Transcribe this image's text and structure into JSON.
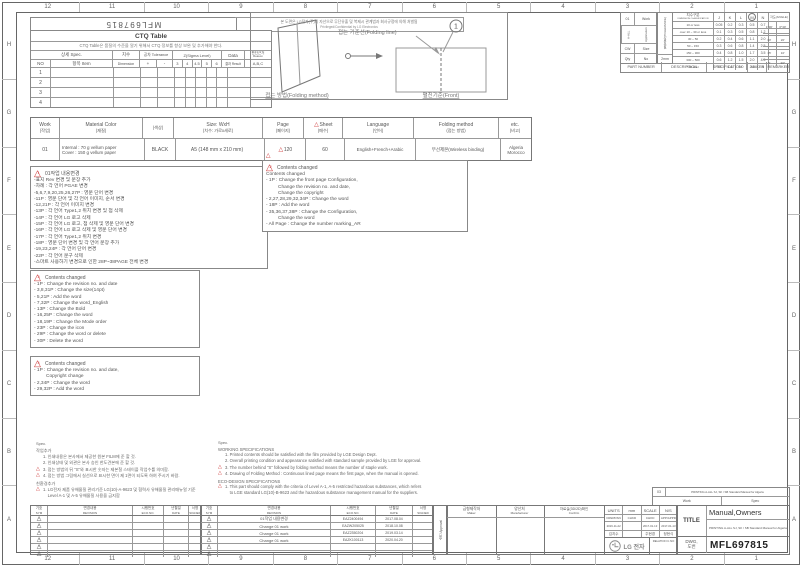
{
  "frame": {
    "top_ruler": [
      "12",
      "11",
      "10",
      "9",
      "8",
      "7",
      "6",
      "5",
      "4",
      "3",
      "2",
      "1"
    ],
    "bottom_ruler": [
      "12",
      "11",
      "10",
      "9",
      "8",
      "7",
      "6",
      "5",
      "4",
      "3",
      "2",
      "1"
    ],
    "left_ruler": [
      "H",
      "G",
      "F",
      "E",
      "D",
      "C",
      "B",
      "A"
    ],
    "right_ruler": [
      "H",
      "G",
      "F",
      "E",
      "D",
      "C",
      "B",
      "A"
    ]
  },
  "icons": {
    "revision_triangle": "△"
  },
  "header": {
    "doc_number_flipped": "MFL697815",
    "confidential_ko": "본 도면은 LG전자(주)의 자산으로 무단유출 및 복제시 관계법과 회사규정에 의해 처벌됨",
    "confidential_en": "Privileged/Confidential by LG Electronics"
  },
  "ctq": {
    "title": "CTQ Table",
    "note": "CTQ Table은 품질의 수준을 알기 위해서 CTQ 정보를 항상 보완 및 추가해야 한다.",
    "spec_header": "상세 Spec.",
    "no_header": "NO",
    "item_header": "항목 Item",
    "dim_ko": "치수",
    "dim_en": "Dimension",
    "tol_header": "공차 Tolerance",
    "tol_plus": "+",
    "tol_minus": "-",
    "sigma_header": "Z(Sigma Level)",
    "sigma_levels": [
      "3",
      "4",
      "4.5",
      "5",
      "6"
    ],
    "data_header": "Data",
    "result_header": "결과 Result",
    "reason_ko": "판단근거",
    "reason_en": "Reason",
    "reason_abc": "A,B,C",
    "rows": [
      "1",
      "2",
      "3",
      "4"
    ]
  },
  "fold": {
    "balloon": "1",
    "line_label": "접는 기준선(Folding line)",
    "method_label": "접는 방법(Folding method)",
    "front_label": "펼친기준(Front)"
  },
  "app_table": {
    "rows": [
      {
        "a": "01",
        "b": "Work"
      },
      {
        "a": "A-ALL",
        "b": "Application"
      },
      {
        "a": "CW",
        "b": "Size"
      },
      {
        "a": "Qty",
        "b": "No"
      }
    ]
  },
  "tol": {
    "band_label": "일반공차(TOLERANCE)",
    "band_note": "2mm",
    "head_ko": "치수구분",
    "head_en": "DIMENSION CLASSIFICATION",
    "cols": [
      "J",
      "K",
      "L",
      "M",
      "N"
    ],
    "angle_label": "각도(ANGLE)",
    "rows": [
      {
        "range": "10 or less",
        "j": "0.05",
        "k": "0.2",
        "l": "0.3",
        "m": "0.5",
        "n": "0.7"
      },
      {
        "range": "over 10 ~ 30 or less",
        "j": "0.1",
        "k": "0.3",
        "l": "0.5",
        "m": "0.8",
        "n": "1.2"
      },
      {
        "range": "30 ~ 50",
        "j": "0.2",
        "k": "0.4",
        "l": "0.6",
        "m": "1.1",
        "n": "2.0"
      },
      {
        "range": "50 ~ 150",
        "j": "0.3",
        "k": "0.6",
        "l": "0.8",
        "m": "1.4",
        "n": "2.5"
      },
      {
        "range": "150 ~ 300",
        "j": "0.4",
        "k": "0.8",
        "l": "1.0",
        "m": "1.7",
        "n": "3.5"
      },
      {
        "range": "300 ~ 500",
        "j": "0.6",
        "k": "1.2",
        "l": "1.5",
        "m": "2.0",
        "n": "4.5"
      },
      {
        "range": "500 over",
        "j": "0.8",
        "k": "1.6",
        "l": "2.0",
        "m": "2.5",
        "n": "6"
      }
    ],
    "angle_rows": [
      {
        "a": "1°30′",
        "b": "0°30′"
      },
      {
        "a": "30′",
        "b": "20′"
      },
      {
        "a": "15′",
        "b": "10′"
      },
      {
        "a": "5′",
        "b": "30″"
      }
    ]
  },
  "part_row": [
    "PART NUMBER",
    "DESCRIPTION",
    "SPECIFICATION",
    "MAKER",
    "REMARKER"
  ],
  "spec_table": {
    "headers": [
      {
        "en": "Work",
        "ko": "(작업)"
      },
      {
        "en": "Material Color",
        "ko": "(재질)"
      },
      {
        "en": "",
        "ko": "(색상)"
      },
      {
        "en": "Size: WxH",
        "ko": "(치수: 가로x세로)"
      },
      {
        "en": "Page",
        "ko": "(페이지)"
      },
      {
        "en": "Sheet",
        "ko": "(매수)"
      },
      {
        "en": "Language",
        "ko": "(언어)"
      },
      {
        "en": "Folding method",
        "ko": "(접는 방법)"
      },
      {
        "en": "etc.",
        "ko": "(비고)"
      }
    ],
    "row": {
      "work": "01",
      "material_1": "Internal : 70 g vellum paper",
      "material_2": "Cover : 150 g vellum paper",
      "color": "BLACK",
      "size": "A5 (148 mm x 210 mm)",
      "page": "120",
      "sheet": "60",
      "language": "English+French+Arabic",
      "folding": "무선제본(Wireless binding)",
      "etc_1": "Algeria",
      "etc_2": "Morocco"
    }
  },
  "boxes": [
    {
      "tri": "1",
      "title": "01작업 내용변경",
      "lines": [
        "-표지 Rev 변경 및 문장 추가",
        "-차례 : 각 언어 PGAE 변경",
        "-5,6,7,9,20,25,26,27P : 영문 단어 변경",
        "-11P : 영문 단어 및 각 언어 이미지, 순서 변경",
        "-12,21P : 각 언어 이미지 변경",
        "-13P : 각 언어 Type1,2 위치 변경 및 점 삭제",
        "-14P : 각 언어 LG 로고 삭제",
        "-15P : 각 언어 LG 로고, 점 삭제 및 영문 단어 변경",
        "-16P : 각 언어 LG 로고 삭제 및 영문 단어 변경",
        "-17P : 각 언어 Type1,2 위치 변경",
        "-18P : 영문 단어 변경 및 각 언어 문장 추가",
        "-19,23,24P : 각 언어 단어 변경",
        "-22P : 각 언어 문구 삭제",
        "-스마트 사용하기 변경으로 인한 28P~38PAGE 전체 변경"
      ]
    },
    {
      "tri": "2",
      "title": "Contents changed",
      "lines": [
        "Contents changed",
        "- 1P : Change the front page Configuration,",
        "         Change the revision no. and date,",
        "         Change the copyright",
        "- 2,27,28,29,32,34P : Change the word",
        "- 18P : Add the word",
        "- 35,36,37,38P : Change the Configuration,",
        "         Change the word",
        "- All Page : Change the number marking_AR"
      ]
    },
    {
      "tri": "3",
      "title": "Contents changed",
      "lines": [
        "- 1P : Change the revision no. and date",
        "- 3,8,31P : Change the size(14pt)",
        "- 5,21P : Add the word",
        "- 7,32P : Change the word_English",
        "- 13P : Change the Bold",
        "- 16,25P : Change the word",
        "- 18,19P : Change the Mode order",
        "- 23P : Change the icon",
        "- 29P : Change the word or delete",
        "- 30P : Delete the word"
      ]
    },
    {
      "tri": "4",
      "title": "Contents changed",
      "lines": [
        "- 1P : Change the revision no. and date,",
        "         Copyright change",
        "- 2,34P : Change the word",
        "- 29,32P : Add the word"
      ]
    }
  ],
  "notes_ko": {
    "spec": "Spec.",
    "sec1": "작업추가",
    "items1": [
      {
        "mark": "",
        "text": "1. 인쇄내용은 본사에서 제공한 원본 FILM에 준 할 것."
      },
      {
        "mark": "",
        "text": "2. 인쇄상태 및 외관은 본사 승인 한도견본에 준 할 것."
      },
      {
        "mark": "△",
        "text": "3. 접는 방법의 뒤 \"S\"와 표시한 숫자는 제본철 스테이플 작업수를 의미함."
      },
      {
        "mark": "△",
        "text": "4. 접는 방법 그림에서 실선으로 표시한 면이 제 1면이 되도록 하여 주시기 바람."
      }
    ],
    "sec2": "친환경추가",
    "items2": [
      {
        "mark": "△",
        "text": "1. LG전자 제품 유해물질 관리기준 LG(10)-A-9623 및 협력사 유해물질 관리매뉴얼 기준"
      },
      {
        "mark": "",
        "text": "    Level A-1 및 A-5 유해물질 사용을 금지함"
      }
    ]
  },
  "notes_en": {
    "spec": "Spec.",
    "sec1": "WORKING SPECIFICATIONS",
    "items1": [
      {
        "mark": "",
        "text": "1. Printed contents should be satisfied with the film provided by LGE Design Dept."
      },
      {
        "mark": "",
        "text": "2. Overall printing condition and appearance satisfied with standard sample provided by LGE for approval."
      },
      {
        "mark": "△",
        "text": "3. The number behind \"S\" followed by folding method means the number of staple work."
      },
      {
        "mark": "△",
        "text": "4. Drawing of Folding Method : Continuous lined page means the first page, when the manual is opened."
      }
    ],
    "sec2": "ECO-DESIGN SPECIFICATIONS",
    "items2": [
      {
        "mark": "△",
        "text": "1. This part should comply with the criteria of Level A-1, A-5 restricted hazardous substances, which refers"
      },
      {
        "mark": "",
        "text": "    to LGE standard LG(10)-B-9623 and the hazardous substance management manual for the suppliers."
      }
    ]
  },
  "work_strip": {
    "no": "03",
    "desc": "PRINTING A-ALL SJ, SK / SB Standard Manual for Algeria",
    "work": "Work",
    "spec": "Spec"
  },
  "rev": {
    "sym_ko": "기호",
    "sym_en": "SYM",
    "rev_ko": "변경내용",
    "rev_en": "REVISION",
    "eco_ko": "시행번호",
    "eco_en": "ECO.NO.",
    "date_ko": "년월일",
    "date_en": "DATE",
    "sign_ko": "서명",
    "sign_en": "SIGNED",
    "left_rows": [
      {
        "sym": "1",
        "revision": "",
        "eco": "",
        "date": ""
      },
      {
        "sym": "2",
        "revision": "",
        "eco": "",
        "date": ""
      },
      {
        "sym": "3",
        "revision": "",
        "eco": "",
        "date": ""
      },
      {
        "sym": "4",
        "revision": "",
        "eco": "",
        "date": ""
      },
      {
        "sym": "5",
        "revision": "",
        "eco": "",
        "date": ""
      },
      {
        "sym": "6",
        "revision": "",
        "eco": "",
        "date": ""
      }
    ],
    "right_rows": [
      {
        "sym": "1",
        "revision": "01작업 내용변경",
        "eco": "EAZ2400494",
        "date": "2017.08.04"
      },
      {
        "sym": "2",
        "revision": "Change 01 work",
        "eco": "EAZW205025",
        "date": "2018.10.08"
      },
      {
        "sym": "3",
        "revision": "Change 01 work",
        "eco": "EAZ2350204",
        "date": "2019.03.14"
      },
      {
        "sym": "4",
        "revision": "Change 01 work",
        "eco": "EAZK100113",
        "date": "2020.04.20"
      },
      {
        "sym": "5",
        "revision": "",
        "eco": "",
        "date": ""
      },
      {
        "sym": "6",
        "revision": "",
        "eco": "",
        "date": ""
      }
    ]
  },
  "title_block": {
    "approval": "승인 Approval",
    "maker_ko": "금형제작처",
    "maker_en": "Maker",
    "manu_ko": "양산처",
    "manu_en": "Manufacturer",
    "confirm_ko": "자료실(3D/2D)확인",
    "confirm_en": "Confirm",
    "units_cols": [
      {
        "h": "UNITS",
        "s": "DRW/DSN",
        "d": "2016-11-22",
        "n": "김지수"
      },
      {
        "h": "mm",
        "s": "CHKD",
        "d": "",
        "n": ""
      },
      {
        "h": "SCALE",
        "s": "CHKD",
        "d": "2017-01-13",
        "n": "주현경"
      },
      {
        "h": "N/S",
        "s": "APP/APPD",
        "d": "2017-01-13",
        "n": "정현식"
      }
    ],
    "relation_label": "RELATION C.NO",
    "logo_text": "LG 전자",
    "title_label": "TITLE",
    "title_1": "Manual,Owners",
    "title_2": "PRINTING A-ALL SJ, SK / SB Standard Manual for Algeria",
    "dwg_label_1": "DWG,",
    "dwg_label_2": "도번",
    "dwg_no": "MFL697815"
  }
}
